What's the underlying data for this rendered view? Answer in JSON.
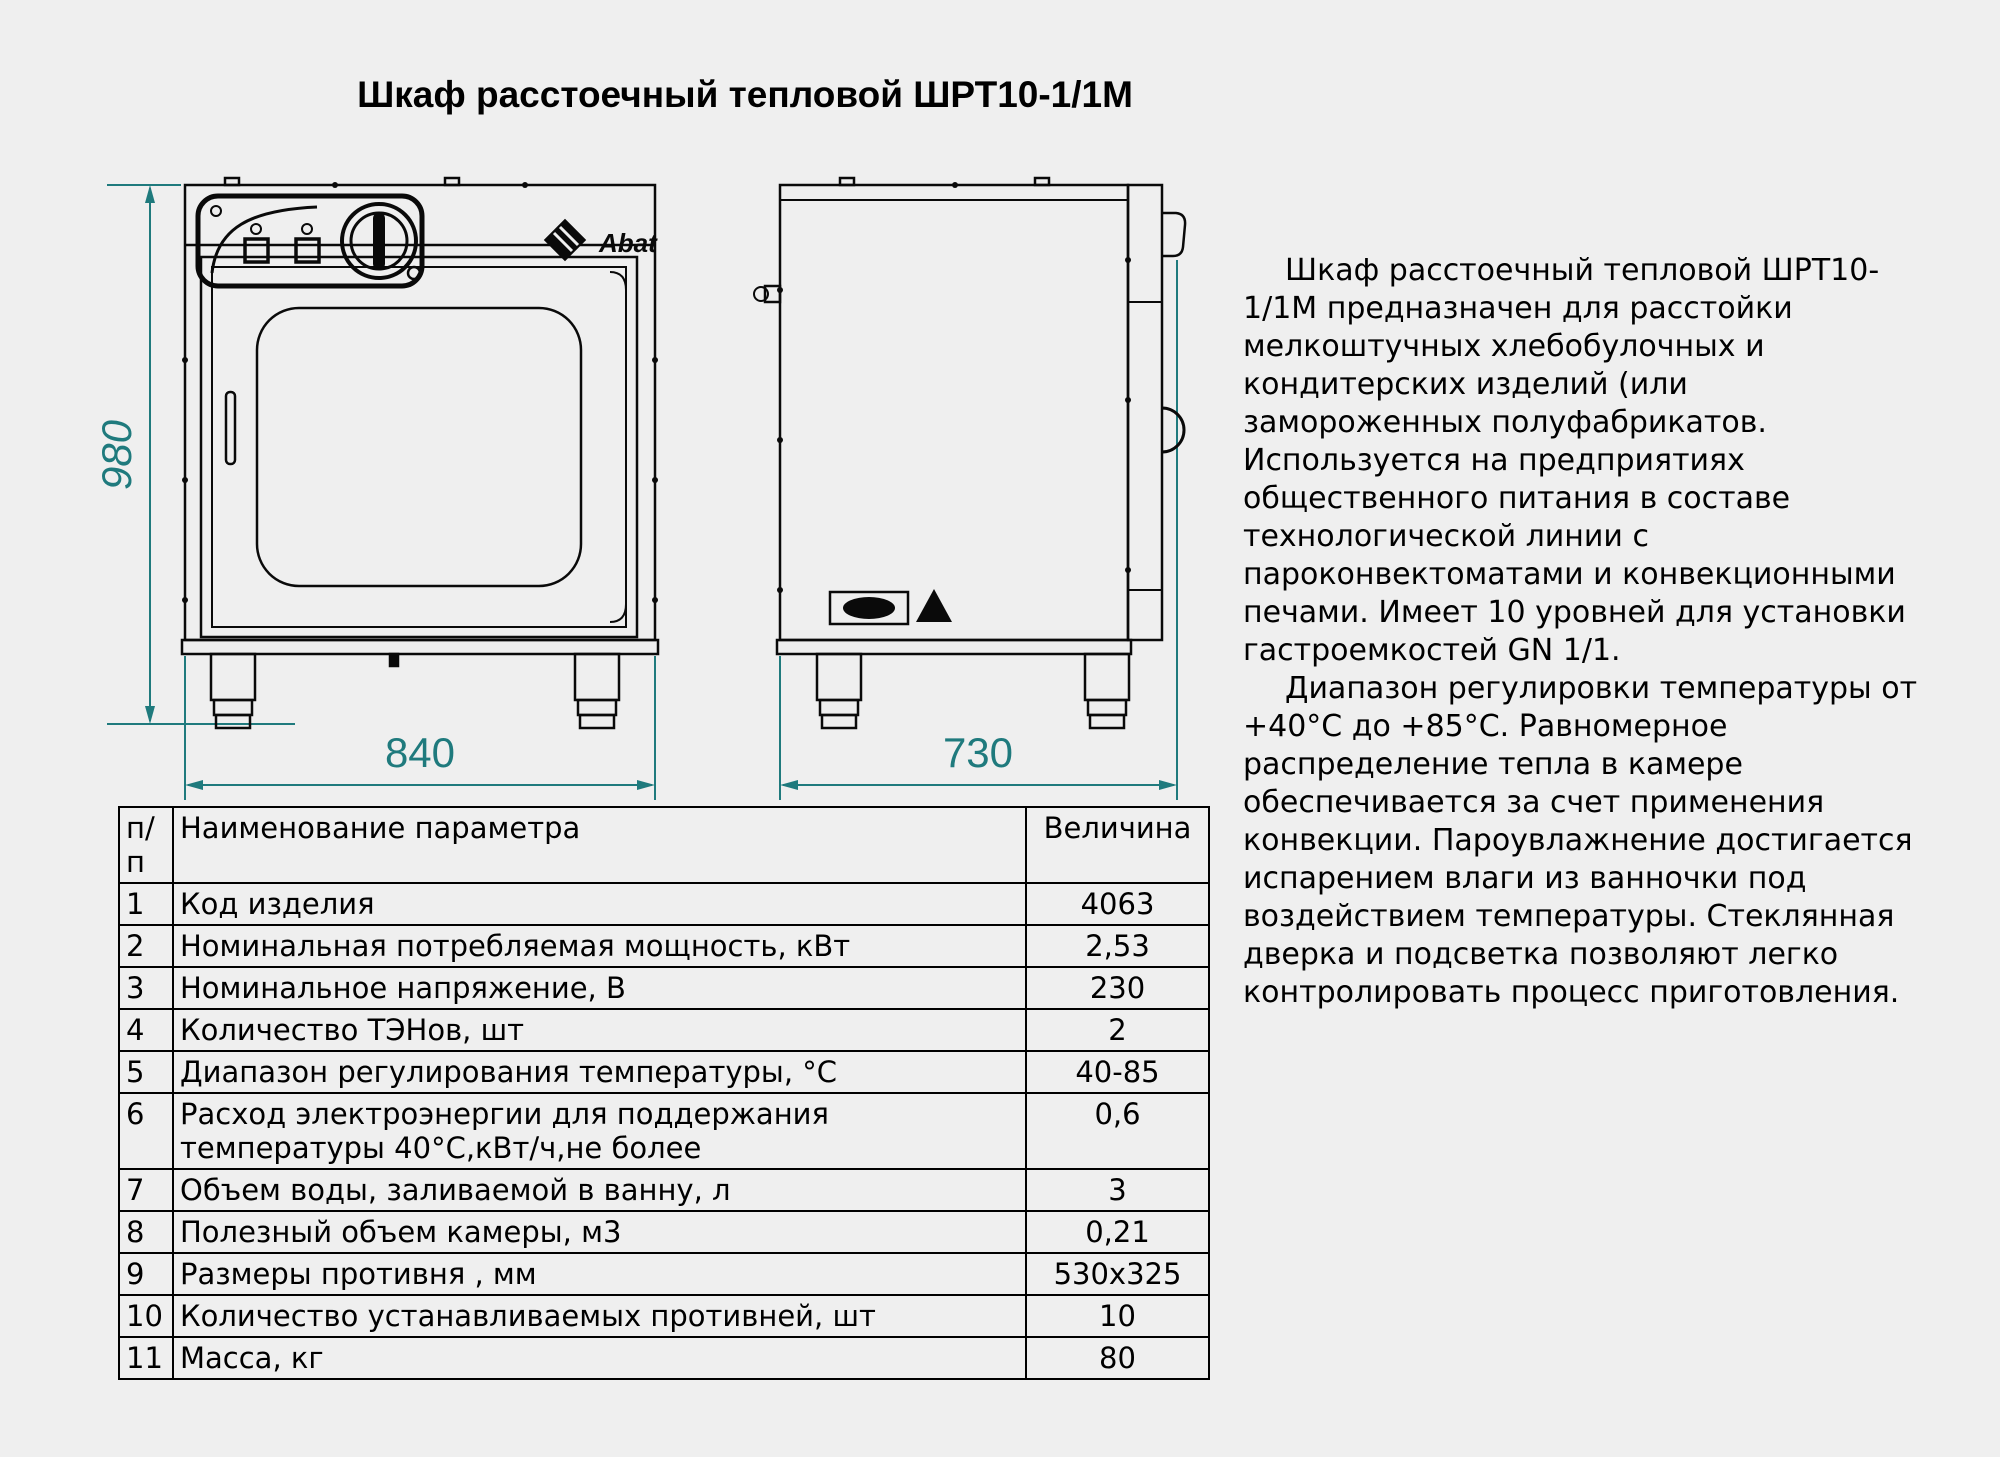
{
  "title": "Шкаф расстоечный тепловой ШРТ10-1/1М",
  "drawings": {
    "front_view": {
      "brand": "Abat",
      "height_mm": "980",
      "width_mm": "840"
    },
    "side_view": {
      "depth_mm": "730"
    }
  },
  "table": {
    "headers": {
      "num": "п/п",
      "name": "Наименование параметра",
      "value": "Величина"
    },
    "rows": [
      {
        "n": "1",
        "name": "Код изделия",
        "value": "4063"
      },
      {
        "n": "2",
        "name": "Номинальная потребляемая мощность, кВт",
        "value": "2,53"
      },
      {
        "n": "3",
        "name": "Номинальное напряжение, В",
        "value": "230"
      },
      {
        "n": "4",
        "name": "Количество ТЭНов, шт",
        "value": "2"
      },
      {
        "n": "5",
        "name": "Диапазон регулирования температуры, °С",
        "value": "40-85"
      },
      {
        "n": "6",
        "name": "Расход электроэнергии для поддержания температуры 40°С,кВт/ч,не более",
        "value": "0,6"
      },
      {
        "n": "7",
        "name": "Объем воды, заливаемой в ванну, л",
        "value": "3"
      },
      {
        "n": "8",
        "name": "Полезный объем камеры, м3",
        "value": "0,21"
      },
      {
        "n": "9",
        "name": "Размеры противня , мм",
        "value": "530x325"
      },
      {
        "n": "10",
        "name": "Количество устанавливаемых противней, шт",
        "value": "10"
      },
      {
        "n": "11",
        "name": "Масса, кг",
        "value": "80"
      }
    ]
  },
  "description": {
    "paragraph1": "Шкаф расстоечный тепловой ШРТ10-1/1М предназначен для расстойки мелкоштучных хлебобулочных и кондитерских изделий (или замороженных полуфабрикатов. Используется на предприятиях общественного питания в составе технологической линии с пароконвектоматами и конвекционными печами. Имеет 10 уровней для установки гастроемкостей GN 1/1.",
    "paragraph2": "Диапазон регулировки температуры от +40°С до +85°С. Равномерное распределение тепла в камере обеспечивается за счет применения конвекции. Пароувлажнение достигается испарением влаги из ванночки под воздействием температуры. Стеклянная дверка и подсветка позволяют легко контролировать процесс приготовления."
  },
  "colors": {
    "dimension_teal": "#1f7a7d",
    "line_black": "#0a0a0a",
    "background": "#efefef"
  }
}
